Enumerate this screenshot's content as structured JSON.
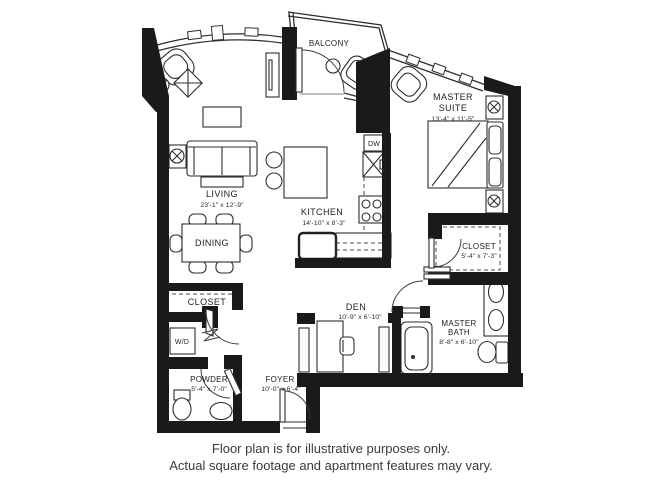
{
  "rooms": {
    "balcony": {
      "label": "BALCONY"
    },
    "master_suite": {
      "label_line1": "MASTER",
      "label_line2": "SUITE",
      "dims": "13'-4\" x 11'-5\""
    },
    "living": {
      "label": "LIVING",
      "dims": "23'-1\" x 12'-9\""
    },
    "kitchen": {
      "label": "KITCHEN",
      "dims": "14'-10\" x 8'-3\""
    },
    "dining": {
      "label": "DINING"
    },
    "master_closet": {
      "label": "CLOSET",
      "dims": "5'-4\" x 7'-3\""
    },
    "master_bath": {
      "label_line1": "MASTER",
      "label_line2": "BATH",
      "dims": "8'-8\" x 6'-10\""
    },
    "den": {
      "label": "DEN",
      "dims": "10'-9\" x 6'-10\""
    },
    "hall_closet": {
      "label": "CLOSET"
    },
    "laundry": {
      "label": "W/D"
    },
    "powder": {
      "label": "POWDER",
      "dims": "5'-4\" x 7'-0\""
    },
    "foyer": {
      "label": "FOYER",
      "dims": "10'-0\" x 6'-4\""
    },
    "appliances": {
      "dishwasher": "DW"
    }
  },
  "footer": {
    "line1": "Floor plan is for illustrative purposes only.",
    "line2": "Actual square footage and apartment features may vary."
  },
  "colors": {
    "wall": "#1a1a1a",
    "line": "#2e2e2e",
    "text": "#1e1e1e",
    "footer_text": "#3a3a3a"
  }
}
